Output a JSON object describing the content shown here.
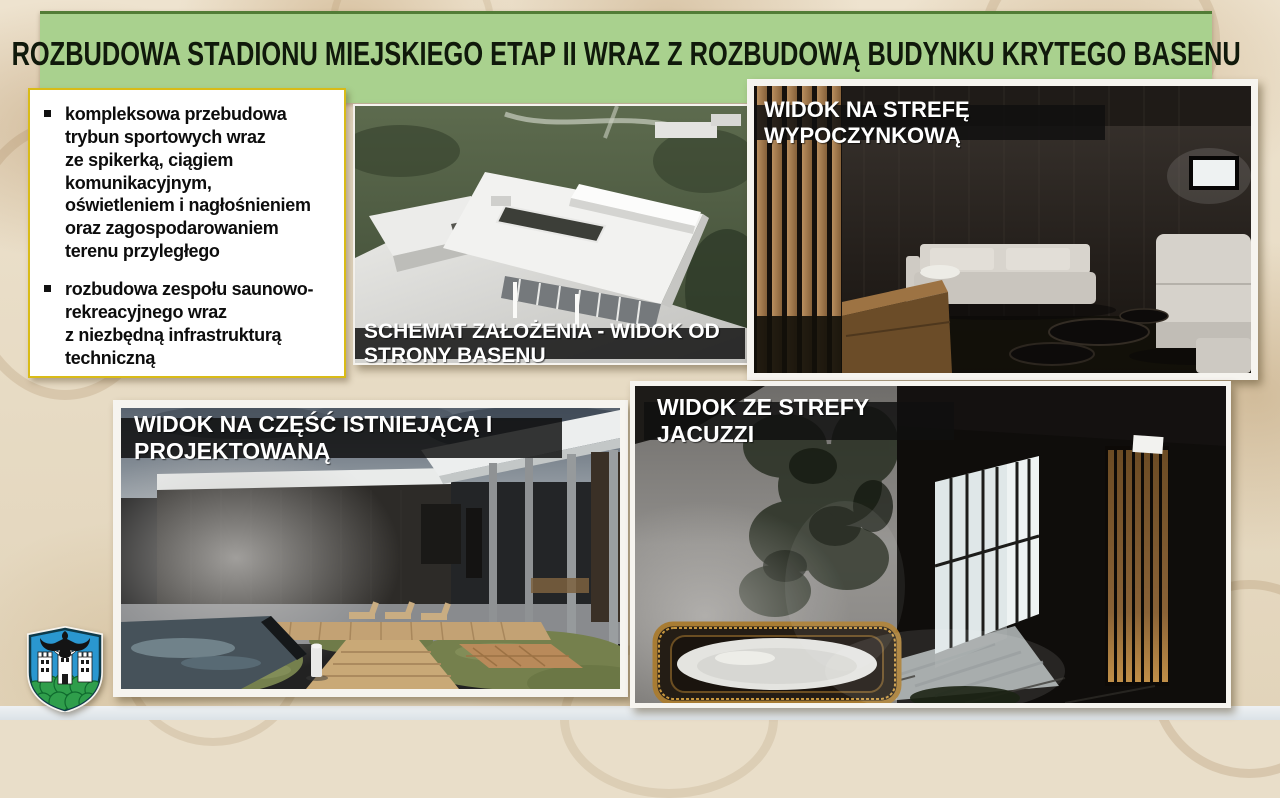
{
  "slide": {
    "title": "ROZBUDOWA STADIONU MIEJSKIEGO ETAP II WRAZ Z ROZBUDOWĄ BUDYNKU KRYTEGO BASENU",
    "bullet_list": {
      "items": [
        {
          "text": "kompleksowa przebudowa\ntrybun sportowych wraz\nze spikerką, ciągiem\nkomunikacyjnym,\noświetleniem i nagłośnieniem\noraz zagospodarowaniem\nterenu przyległego"
        },
        {
          "text": "rozbudowa zespołu saunowo-\nrekreacyjnego wraz\nz niezbędną infrastrukturą\ntechniczną"
        }
      ]
    },
    "renders": [
      {
        "name": "schemat-zalozenia-render",
        "caption": "SCHEMAT ZAŁOŻENIA - WIDOK OD STRONY BASENU"
      },
      {
        "name": "strefa-wypoczynkowa-render",
        "caption": "WIDOK NA STREFĘ WYPOCZYNKOWĄ"
      },
      {
        "name": "czesc-istniejaca-projektowana-render",
        "caption": "WIDOK NA CZĘŚĆ ISTNIEJĄCĄ I PROJEKTOWANĄ"
      },
      {
        "name": "strefa-jacuzzi-render",
        "caption": "WIDOK ZE STREFY JACUZZI"
      }
    ],
    "logo_icon": "city-coat-of-arms",
    "colors": {
      "title_bar_bg": "#a9d18e",
      "title_bar_border": "#527c36",
      "title_text": "#10190b",
      "textbox_border": "#d9bb17",
      "caption_bar_bg": "#101010",
      "caption_text": "#ffffff",
      "background_base": "#e9dec9",
      "footer_strip": "#dde3e8",
      "shield_blue": "#2a97d0",
      "shield_green": "#2f9e4b"
    }
  }
}
